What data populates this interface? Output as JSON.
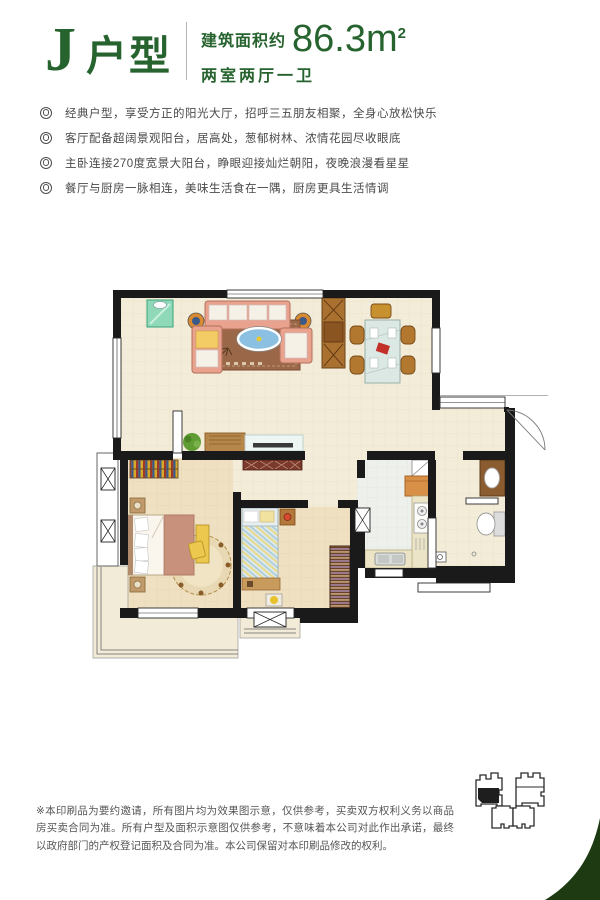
{
  "header": {
    "unit_letter": "J",
    "unit_label": "户型",
    "area_prefix": "建筑面积约",
    "area_value": "86.3m",
    "area_sup": "2",
    "layout_text": "两室两厅一卫"
  },
  "features": [
    "经典户型，享受方正的阳光大厅，招呼三五朋友相聚，全身心放松快乐",
    "客厅配备超阔景观阳台，居高处，葱郁树林、浓情花园尽收眼底",
    "主卧连接270度宽景大阳台，睁眼迎接灿烂朝阳，夜晚浪漫看星星",
    "餐厅与厨房一脉相连，美味生活食在一隅，厨房更具生活情调"
  ],
  "disclaimer": "※本印刷品为要约邀请，所有图片均为效果图示意，仅供参考，买卖双方权利义务以商品房买卖合同为准。所有户型及面积示意图仅供参考，不意味着本公司对此作出承诺，最终以政府部门的产权登记面积及合同为准。本公司保留对本印刷品修改的权利。",
  "colors": {
    "brand_green": "#26632e",
    "wedge_green": "#1d3a12",
    "wall_black": "#1a1a1a",
    "floor_beige": "#f2ecd8",
    "text_gray": "#4a4a4a",
    "disclaimer_gray": "#555555"
  }
}
